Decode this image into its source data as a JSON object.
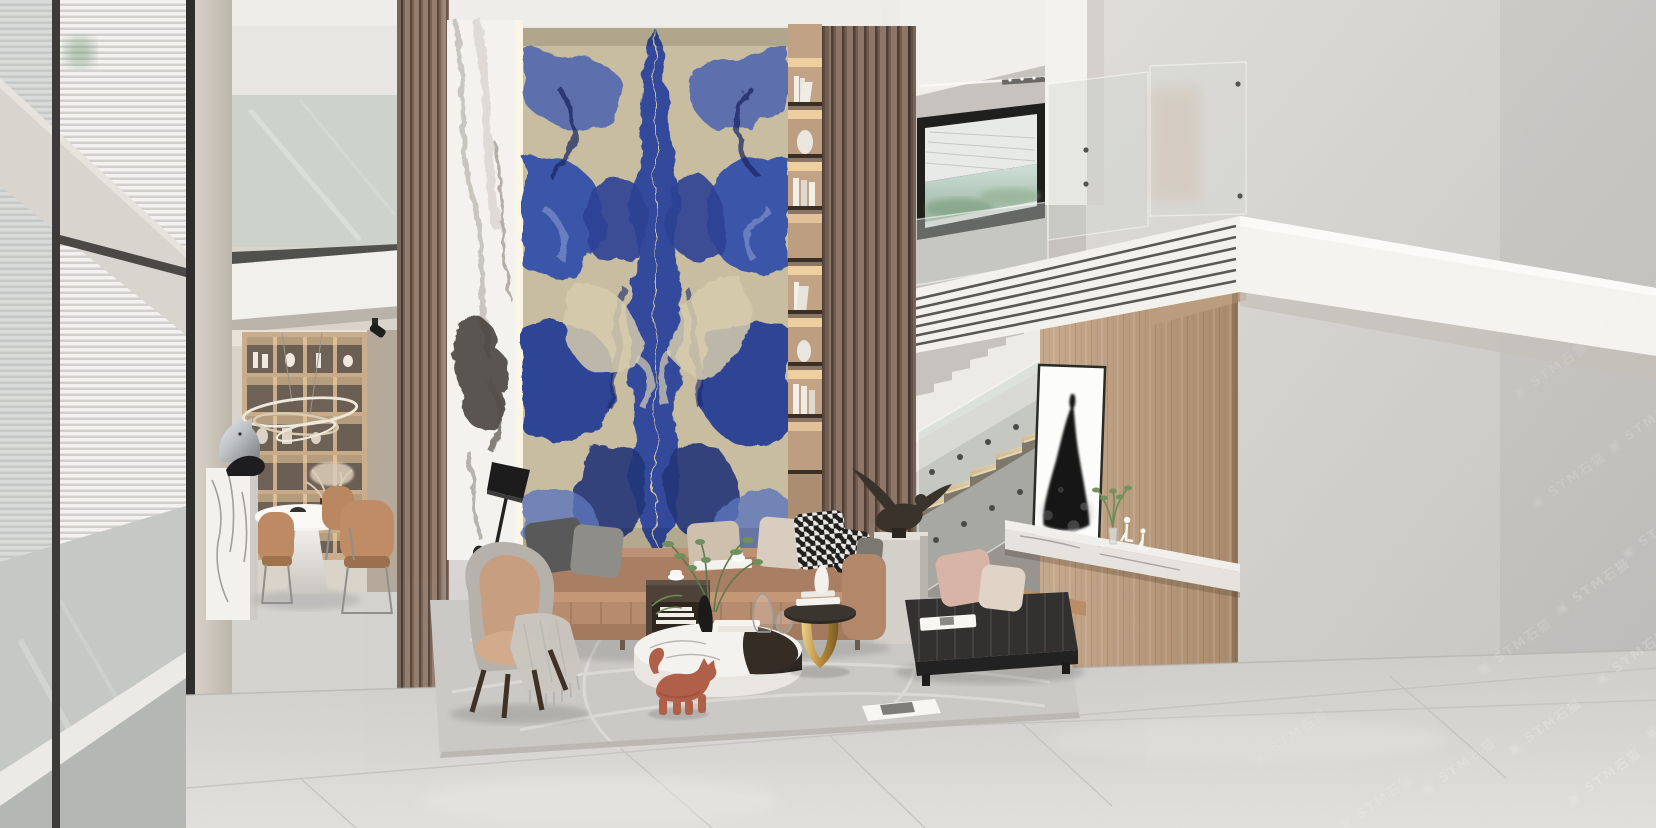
{
  "scene": {
    "kind": "photorealistic 3D interior render",
    "setting": "double-height modern villa living room with mezzanine",
    "objects": [
      "left-curtain-wall-window",
      "venetian-blinds",
      "dining-table",
      "dining-chairs",
      "wine-display-cabinet",
      "ring-pendant-light",
      "marble-pedestal",
      "chrome-horse-sculpture",
      "wood-slat-partition",
      "white-calacatta-marble-panel",
      "blue-sodalite-marble-feature-wall",
      "backlit-display-niche",
      "staircase",
      "stair-glass-balustrade",
      "mezzanine-slab",
      "louvered-fascia",
      "picture-window",
      "wood-feature-wall",
      "dress-artwork",
      "marble-floating-shelf",
      "wire-figurines",
      "leather-sectional-sofa",
      "throw-pillows",
      "houndstooth-pillows",
      "lounge-armchair",
      "fringe-throw",
      "black-floor-lamp",
      "round-marble-coffee-table",
      "gold-side-table",
      "wood-cube-side-table",
      "cat-sculpture",
      "black-leather-bench",
      "stone-plinth",
      "bird-sculpture",
      "area-rug",
      "magazine",
      "marble-tile-floor"
    ]
  },
  "watermark": {
    "icon": "▣",
    "text": "STM石猫",
    "color": "#ffffff",
    "angle_deg": -35,
    "instances": [
      {
        "x": 1588,
        "y": 292,
        "o": 0.1
      },
      {
        "x": 1506,
        "y": 360,
        "o": 0.1
      },
      {
        "x": 1600,
        "y": 414,
        "o": 0.13
      },
      {
        "x": 1524,
        "y": 470,
        "o": 0.12
      },
      {
        "x": 1614,
        "y": 520,
        "o": 0.15
      },
      {
        "x": 1548,
        "y": 576,
        "o": 0.16
      },
      {
        "x": 1470,
        "y": 636,
        "o": 0.14
      },
      {
        "x": 1588,
        "y": 646,
        "o": 0.18
      },
      {
        "x": 1638,
        "y": 700,
        "o": 0.18
      },
      {
        "x": 1500,
        "y": 716,
        "o": 0.17
      },
      {
        "x": 1560,
        "y": 766,
        "o": 0.19
      },
      {
        "x": 1414,
        "y": 756,
        "o": 0.14
      },
      {
        "x": 1332,
        "y": 792,
        "o": 0.12
      },
      {
        "x": 1246,
        "y": 726,
        "o": 0.1
      }
    ]
  },
  "palette": {
    "wall_concrete": "#cdcbc8",
    "floor_tile": "#d8d6d3",
    "wood_slat": "#8a7265",
    "wood_wall": "#bb9c7e",
    "marble_blue": "#33489c",
    "marble_cream": "#c8bda0",
    "sofa_leather": "#b78c6e",
    "bench_leather": "#2f2e2e",
    "stair_tread": "#e2c08f",
    "gold_accent": "#c29a52",
    "cat_terracotta": "#b05f48",
    "artwork_ink": "#151515"
  }
}
